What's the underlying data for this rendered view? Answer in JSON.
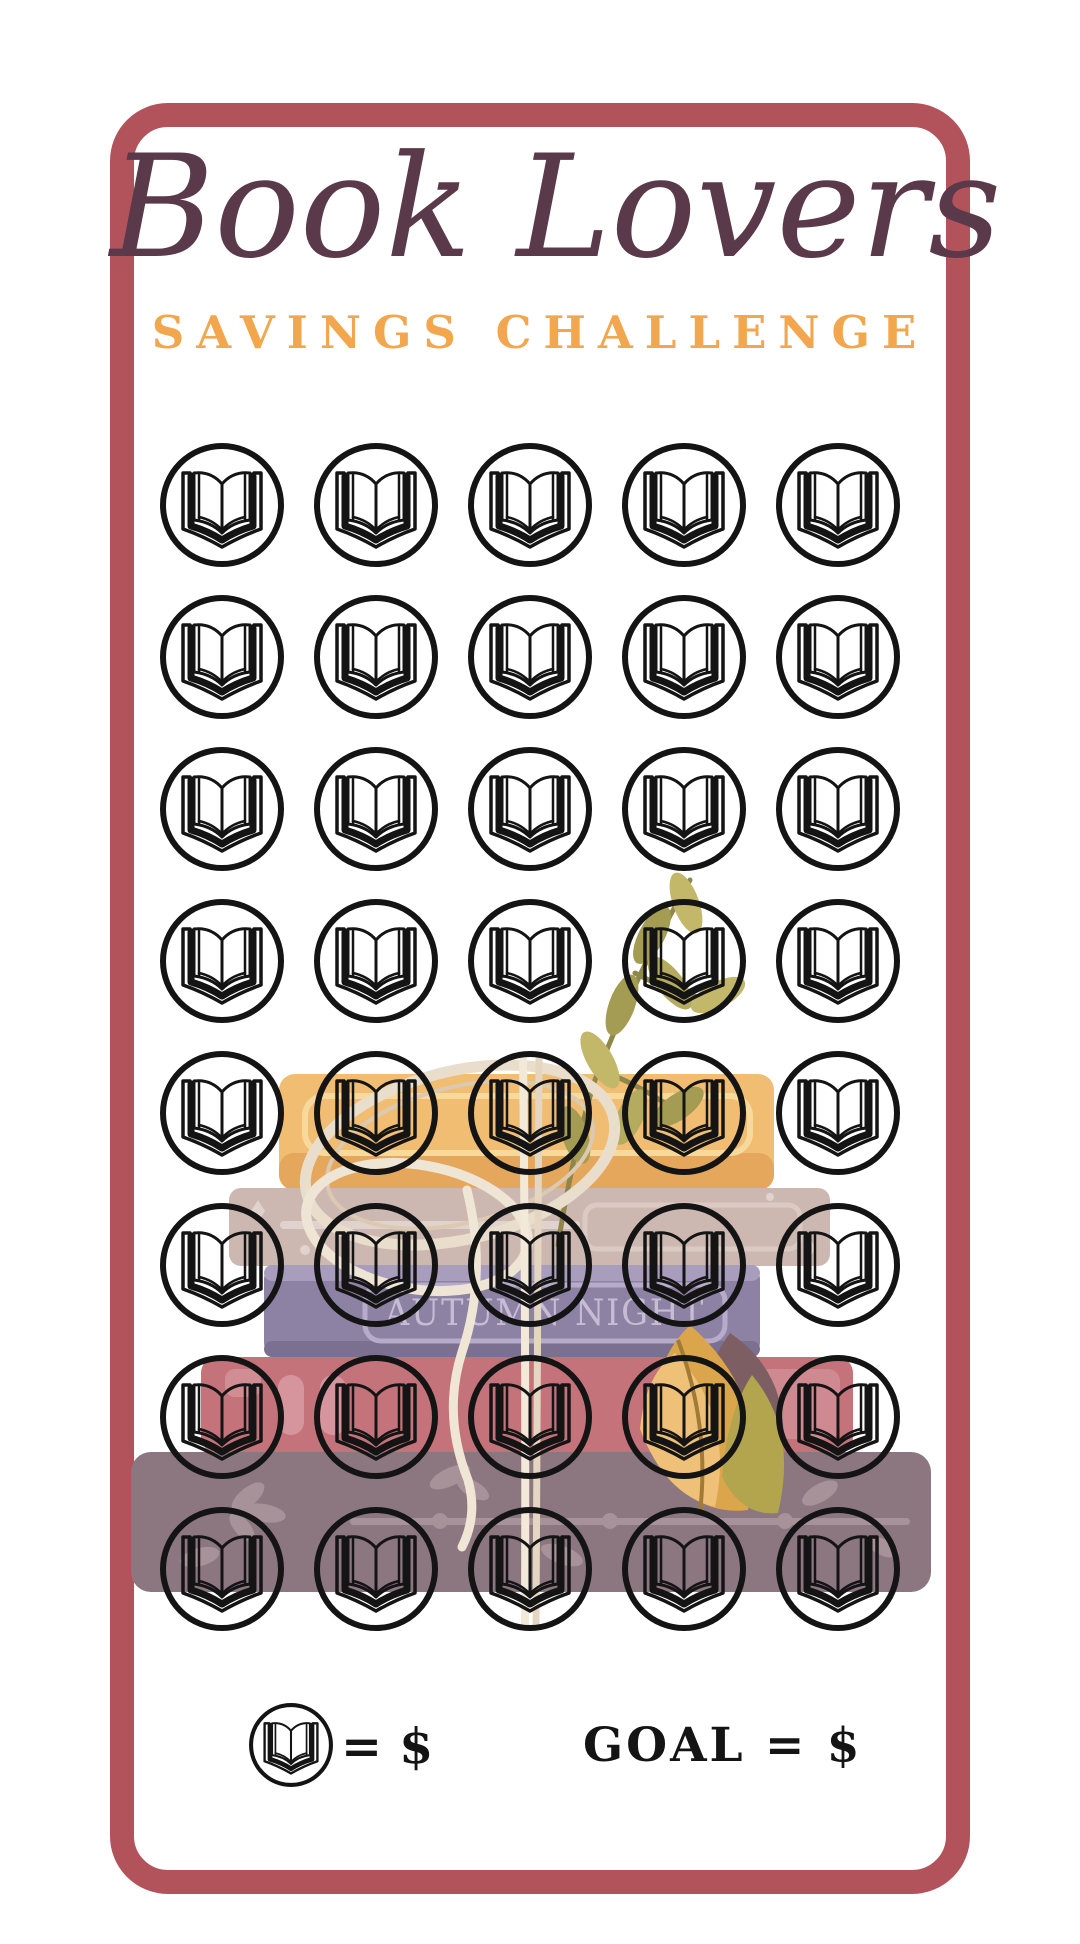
{
  "page": {
    "background": "#ffffff"
  },
  "card": {
    "border_color": "#b2535c",
    "background": "#ffffff"
  },
  "header": {
    "title": "Book Lovers",
    "title_color": "#5a3a4a",
    "subtitle": "SAVINGS CHALLENGE",
    "subtitle_color": "#f2a74e"
  },
  "grid": {
    "rows": 8,
    "columns": 5,
    "total_slots": 40,
    "slot_icon": "open-book-icon",
    "icon_color": "#141414"
  },
  "legend": {
    "icon": "open-book-icon",
    "unit_label": "= $",
    "goal_label": "GOAL = $"
  },
  "illustration": {
    "description": "stack of books with olive branch, cream ribbon and gold feather",
    "spine_text": "AUTUMN NIGHT",
    "colors": {
      "yellow_book": "#f1bd72",
      "yellow_book_band": "#e5a75c",
      "tan_book": "#cdb8b1",
      "purple_book": "#8e82a4",
      "purple_spine_text": "#c6bdd4",
      "red_book": "#c4737b",
      "mauve_book": "#8c7680",
      "feather_gold": "#dba54b",
      "leaves_olive": "#a39c52",
      "ribbon_cream": "#e9ddcb"
    }
  }
}
